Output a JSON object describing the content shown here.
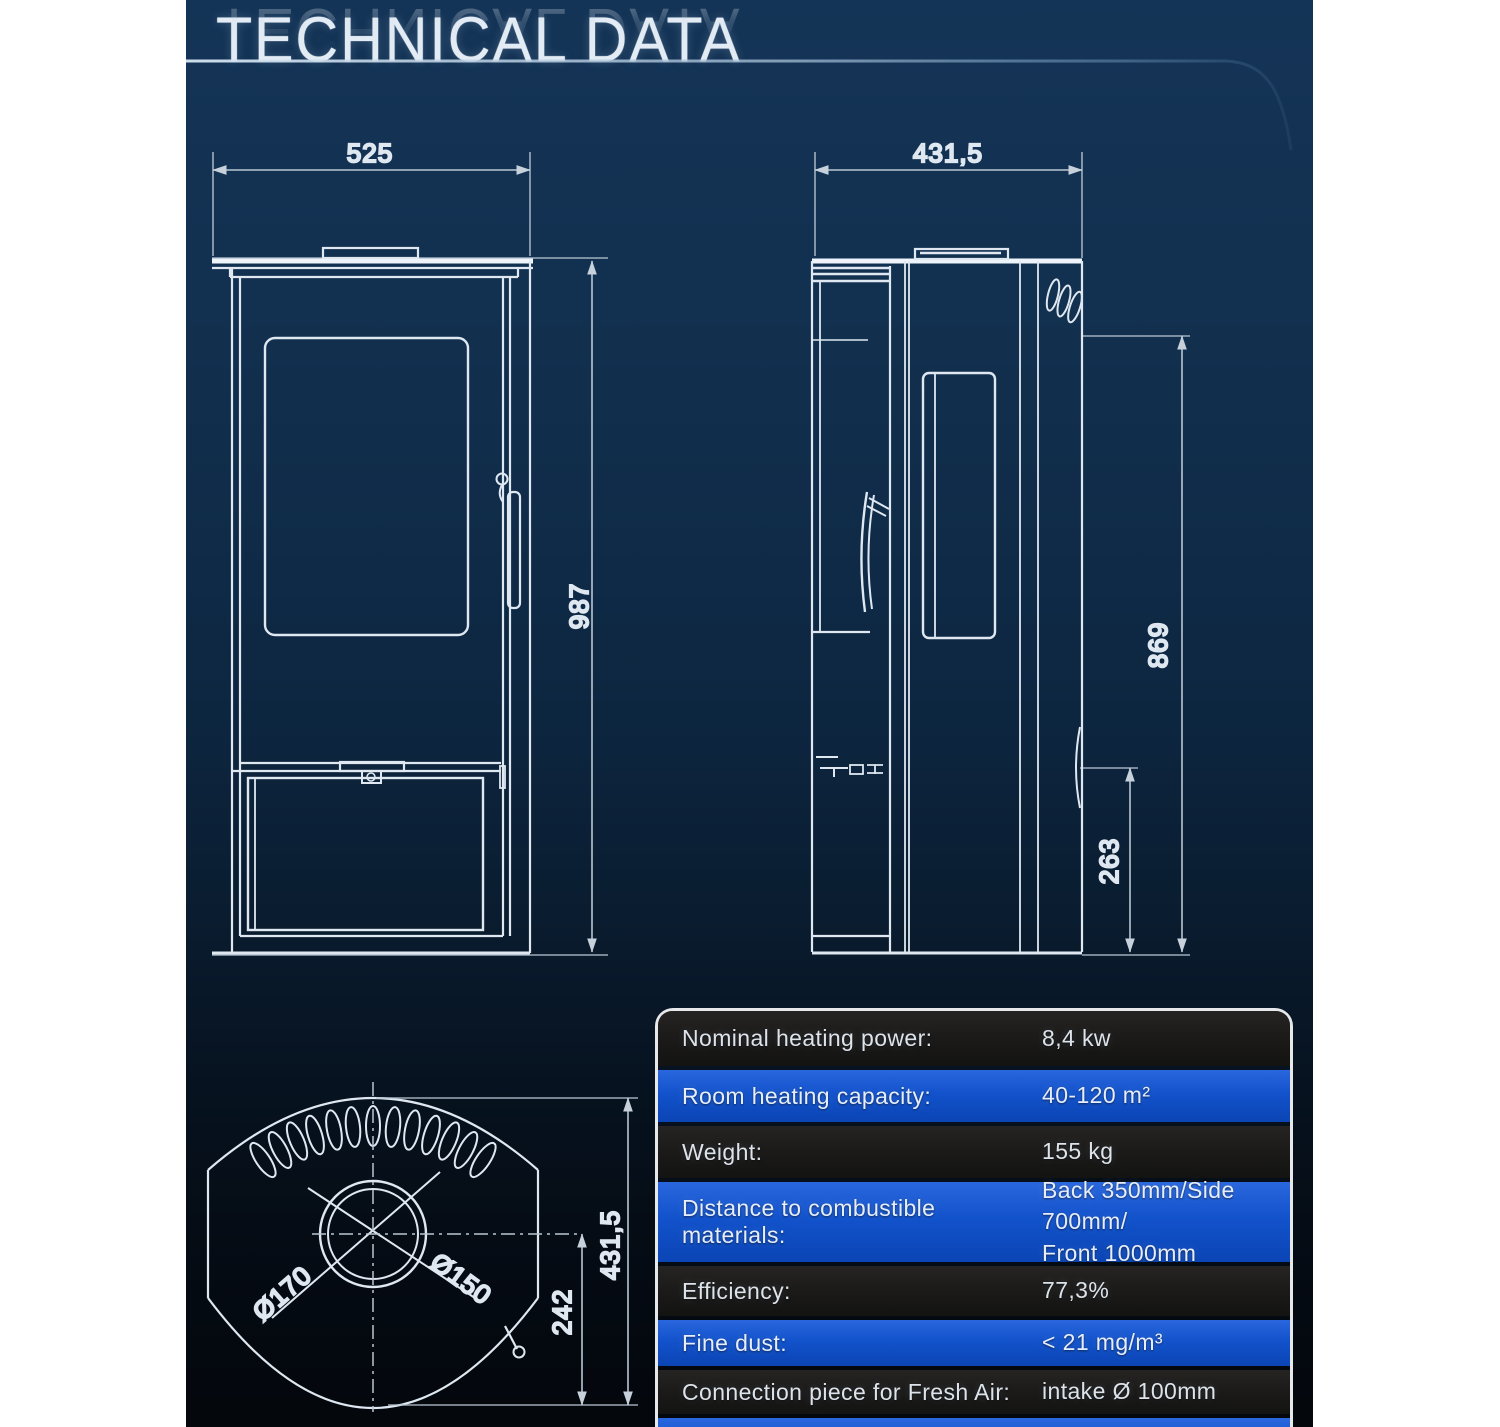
{
  "title": "TECHNICAL DATA",
  "front_view": {
    "width_label": "525",
    "height_label": "987"
  },
  "side_view": {
    "depth_label": "431,5",
    "height_label": "869",
    "base_height_label": "263"
  },
  "top_view": {
    "flue_outer_label": "Ø170",
    "flue_inner_label": "Ø150",
    "offset_label": "242",
    "depth_label": "431,5"
  },
  "spec_table": {
    "rows": [
      {
        "label": "Nominal heating power:",
        "value": "8,4 kw"
      },
      {
        "label": "Room heating capacity:",
        "value": "40-120 m²"
      },
      {
        "label": "Weight:",
        "value": "155 kg"
      },
      {
        "label": "Distance to combustible materials:",
        "value": "Back 350mm/Side 700mm/",
        "value2": "Front 1000mm"
      },
      {
        "label": "Efficiency:",
        "value": "77,3%"
      },
      {
        "label": "Fine dust:",
        "value": "< 21 mg/m³"
      },
      {
        "label": "Connection piece for Fresh Air:",
        "value": "intake Ø 100mm"
      },
      {
        "label": "",
        "value": ""
      }
    ]
  },
  "colors": {
    "accent_blue": "#1152cb",
    "row_dark": "#1d1c1b",
    "drawing_line": "#dfe8f1",
    "page_top": "#143457",
    "page_bottom": "#04060b",
    "table_border": "#e6e8ea"
  }
}
